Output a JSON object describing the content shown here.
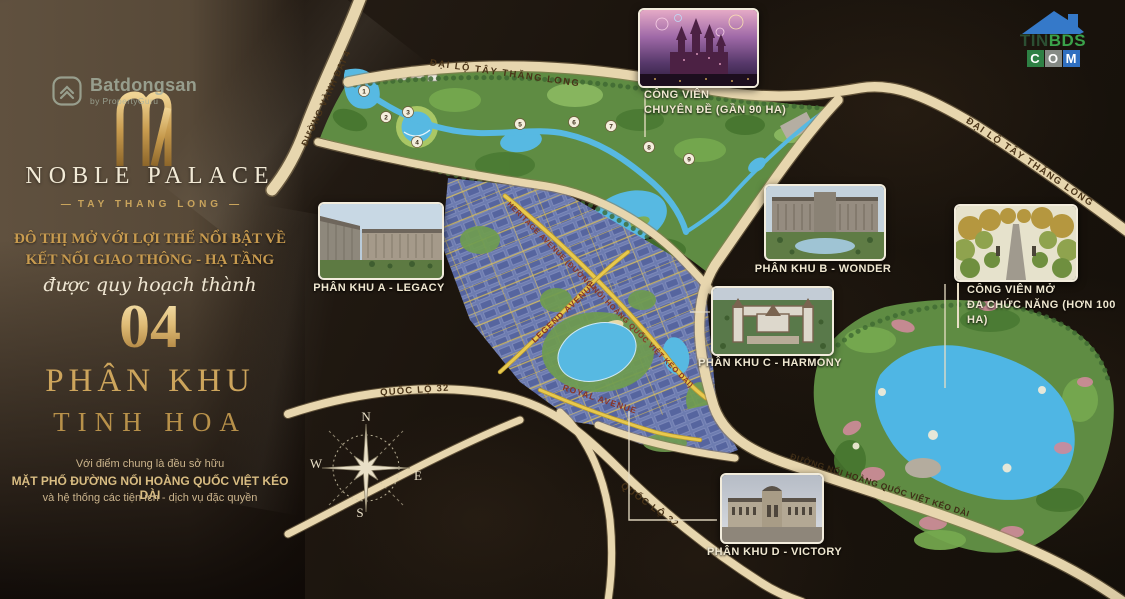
{
  "watermark": {
    "name": "Batdongsan",
    "byline": "by PropertyGuru"
  },
  "tinbds": {
    "tin": "TIN",
    "bds": "BDS",
    "c": "C",
    "o": "O",
    "m": "M"
  },
  "panel": {
    "title": "NOBLE PALACE",
    "subtitle": "TAY THANG LONG",
    "dash": "—",
    "headline1": "ĐÔ THỊ MỞ VỚI LỢI THẾ NỔI BẬT VỀ",
    "headline2": "KẾT NỐI GIAO THÔNG - HẠ TẦNG",
    "script": "được quy hoạch thành",
    "number": "04",
    "label1": "PHÂN KHU",
    "label2": "TINH HOA",
    "note1": "Với điểm chung là đều sở hữu",
    "note2": "MẶT PHỐ ĐƯỜNG NỐI HOÀNG QUỐC VIỆT KÉO DÀI",
    "note3": "và hệ thống các tiện ích - dịch vụ đặc quyền"
  },
  "callouts": {
    "theme_park": {
      "line1": "CÔNG VIÊN",
      "line2": "CHUYÊN ĐỀ (GẦN 90 HA)"
    },
    "zone_a": "PHÂN KHU A - LEGACY",
    "zone_b": "PHÂN KHU B - WONDER",
    "zone_c": "PHÂN KHU C - HARMONY",
    "zone_d": "PHÂN KHU D - VICTORY",
    "open_park": {
      "line1": "CÔNG VIÊN MỞ",
      "line2": "ĐA CHỨC NĂNG (HƠN 100 HA)"
    }
  },
  "map": {
    "roads": {
      "ring_road": "ĐƯỜNG VÀNH ĐAI 4",
      "ttl_top": "ĐẠI LỘ TÂY THĂNG LONG",
      "ttl_right": "ĐẠI LỘ TÂY THĂNG LONG",
      "heritage": "HERITAGE AVENUE (ĐƯỜNG NỐI HOÀNG QUỐC VIỆT KÉO DÀI)",
      "legend": "LEGEND AVENUE",
      "royal": "ROYAL AVENUE",
      "ql32_west": "QUỐC LỘ 32",
      "ql32_south": "QUỐC LỘ 32",
      "hqv_ext": "ĐƯỜNG NỐI HOÀNG QUỐC VIỆT KÉO DÀI"
    },
    "compass": {
      "n": "N",
      "e": "E",
      "s": "S",
      "w": "W"
    },
    "markers": [
      "1",
      "2",
      "3",
      "4",
      "5",
      "6",
      "7",
      "8",
      "9"
    ]
  },
  "colors": {
    "gold": "#c9a45c",
    "cream": "#f2ead6",
    "road": "#e7d6ae",
    "water": "#57b9e2",
    "park_green": "#5f8c43",
    "urban_blue": "#5b6aa4",
    "accent_yellow": "#e8c94e"
  }
}
